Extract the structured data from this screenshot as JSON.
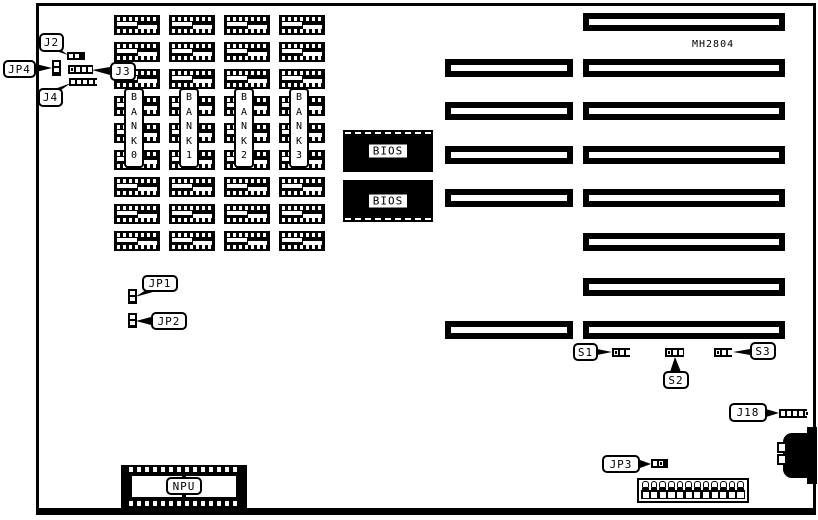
{
  "board": {
    "model": "MH2804"
  },
  "banks": [
    {
      "vertical_label": "B\nA\nN\nK\n0"
    },
    {
      "vertical_label": "B\nA\nN\nK\n1"
    },
    {
      "vertical_label": "B\nA\nN\nK\n2"
    },
    {
      "vertical_label": "B\nA\nN\nK\n3"
    }
  ],
  "memory": {
    "columns": 4,
    "chips_per_column": 9
  },
  "bios": {
    "label": "BIOS",
    "count": 2
  },
  "npu": {
    "label": "NPU"
  },
  "callouts": {
    "j2": "J2",
    "jp4": "JP4",
    "j3": "J3",
    "j4": "J4",
    "jp1": "JP1",
    "jp2": "JP2",
    "s1": "S1",
    "s2": "S2",
    "s3": "S3",
    "j18": "J18",
    "jp3": "JP3"
  },
  "slots": {
    "long_count": 8,
    "short_count": 5
  },
  "power_connector": {
    "pin_count": 12
  },
  "colors": {
    "ink": "#000000",
    "paper": "#ffffff"
  }
}
